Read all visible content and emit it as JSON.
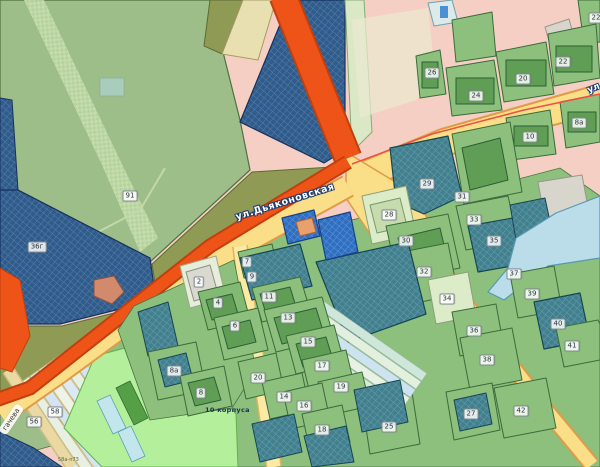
{
  "map": {
    "streets": {
      "dyakonovskaya": "ул.Дьяконовская",
      "dyakonovskaya_edge_fragment": "ул.Дьяконовская",
      "gacheva_fragment": "гачева"
    },
    "annotations": [
      {
        "text": "10 корпуса",
        "x": 205,
        "y": 406
      },
      {
        "text": "58а-п73",
        "x": 58,
        "y": 457
      }
    ],
    "parcel_labels": [
      {
        "text": "91",
        "x": 130,
        "y": 196
      },
      {
        "text": "36г",
        "x": 37,
        "y": 247
      },
      {
        "text": "22",
        "x": 596,
        "y": 18
      },
      {
        "text": "22",
        "x": 563,
        "y": 62
      },
      {
        "text": "20",
        "x": 523,
        "y": 79
      },
      {
        "text": "24",
        "x": 476,
        "y": 96
      },
      {
        "text": "26",
        "x": 432,
        "y": 73
      },
      {
        "text": "10",
        "x": 530,
        "y": 137
      },
      {
        "text": "8а",
        "x": 579,
        "y": 123
      },
      {
        "text": "29",
        "x": 427,
        "y": 184
      },
      {
        "text": "31",
        "x": 462,
        "y": 197
      },
      {
        "text": "28",
        "x": 389,
        "y": 215
      },
      {
        "text": "33",
        "x": 474,
        "y": 220
      },
      {
        "text": "30",
        "x": 406,
        "y": 241
      },
      {
        "text": "35",
        "x": 494,
        "y": 241
      },
      {
        "text": "32",
        "x": 424,
        "y": 272
      },
      {
        "text": "37",
        "x": 514,
        "y": 274
      },
      {
        "text": "34",
        "x": 447,
        "y": 299
      },
      {
        "text": "39",
        "x": 532,
        "y": 294
      },
      {
        "text": "36",
        "x": 474,
        "y": 331
      },
      {
        "text": "40",
        "x": 558,
        "y": 324
      },
      {
        "text": "41",
        "x": 572,
        "y": 346
      },
      {
        "text": "38",
        "x": 487,
        "y": 360
      },
      {
        "text": "42",
        "x": 521,
        "y": 411
      },
      {
        "text": "27",
        "x": 471,
        "y": 414
      },
      {
        "text": "25",
        "x": 389,
        "y": 427
      },
      {
        "text": "18",
        "x": 322,
        "y": 430
      },
      {
        "text": "16",
        "x": 304,
        "y": 406
      },
      {
        "text": "14",
        "x": 284,
        "y": 397
      },
      {
        "text": "20",
        "x": 258,
        "y": 378
      },
      {
        "text": "19",
        "x": 341,
        "y": 387
      },
      {
        "text": "17",
        "x": 322,
        "y": 366
      },
      {
        "text": "15",
        "x": 308,
        "y": 342
      },
      {
        "text": "13",
        "x": 288,
        "y": 318
      },
      {
        "text": "11",
        "x": 269,
        "y": 297
      },
      {
        "text": "9",
        "x": 252,
        "y": 277
      },
      {
        "text": "7",
        "x": 247,
        "y": 262
      },
      {
        "text": "6",
        "x": 235,
        "y": 326
      },
      {
        "text": "4",
        "x": 218,
        "y": 303
      },
      {
        "text": "2",
        "x": 199,
        "y": 282
      },
      {
        "text": "8а",
        "x": 174,
        "y": 371
      },
      {
        "text": "8",
        "x": 201,
        "y": 393
      },
      {
        "text": "58",
        "x": 55,
        "y": 412
      },
      {
        "text": "56",
        "x": 34,
        "y": 422
      }
    ],
    "palette": {
      "background_pink": "#f5cfc3",
      "parcel_navy": "#2f5c8c",
      "parcel_teal": "#41808f",
      "parcel_green": "#8cc07c",
      "parcel_sage": "#9dbe88",
      "parcel_olive": "#8f9a55",
      "parcel_pale": "#dcebc8",
      "building_green": "#5f9e54",
      "road_orange": "#ee5418",
      "road_yellow": "#fbdf88",
      "road_casing": "#e09a48",
      "water_cyan": "#badde9",
      "zone_lime": "#b4ef9b",
      "strip_blue": "#d7e7f3",
      "boundary_red": "#ee5044",
      "bright_blue": "#2f6fc2"
    }
  }
}
